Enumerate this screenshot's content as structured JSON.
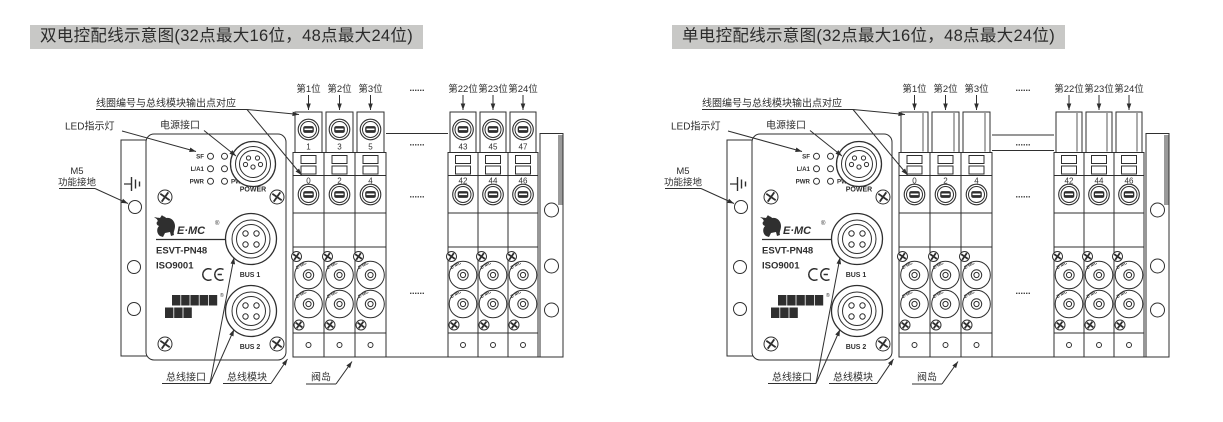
{
  "page": {
    "background": "#ffffff",
    "line_color": "#2f2f2f",
    "title_bg": "#c8c8c6",
    "title_text_color": "#2b2b2b",
    "shade_color": "#9a9a9a",
    "ellipsis": "......"
  },
  "diagrams": [
    {
      "variant": "dual",
      "title": "双电控配线示意图(32点最大16位，48点最大24位)",
      "callouts": {
        "coil_note": "线圈编号与总线模块输出点对应",
        "led": "LED指示灯",
        "power": "电源接口",
        "m5": [
          "M5",
          "功能接地"
        ],
        "bus_port": "总线接口",
        "bus_module": "总线模块",
        "valve_island": "阀岛"
      },
      "module": {
        "led_left": [
          "SF",
          "L/A1",
          "PWR"
        ],
        "led_right": [
          "BF",
          "L/A2",
          "PWM"
        ],
        "power_label": "POWER",
        "brand": "E·MC",
        "brand_reg": "®",
        "model": "ESVT-PN48",
        "cert": "ISO9001",
        "ce_mark": "CE",
        "fieldbus_logo": [
          "PROFI",
          "NET"
        ],
        "fieldbus_reg": "®",
        "bus1_label": "BUS 1",
        "bus2_label": "BUS 2",
        "coil_brand": "E·MC"
      },
      "valve_positions": {
        "left": [
          "第1位",
          "第2位",
          "第3位"
        ],
        "right": [
          "第22位",
          "第23位",
          "第24位"
        ]
      },
      "coil_numbers": {
        "top_left": [
          "1",
          "3",
          "5"
        ],
        "top_right": [
          "43",
          "45",
          "47"
        ],
        "bottom_left": [
          "0",
          "2",
          "4"
        ],
        "bottom_right": [
          "42",
          "44",
          "46"
        ]
      }
    },
    {
      "variant": "single",
      "title": "单电控配线示意图(32点最大16位，48点最大24位)",
      "callouts": {
        "coil_note": "线圈编号与总线模块输出点对应",
        "led": "LED指示灯",
        "power": "电源接口",
        "m5": [
          "M5",
          "功能接地"
        ],
        "bus_port": "总线接口",
        "bus_module": "总线模块",
        "valve_island": "阀岛"
      },
      "module": {
        "led_left": [
          "SF",
          "L/A1",
          "PWR"
        ],
        "led_right": [
          "BF",
          "L/A2",
          "PWM"
        ],
        "power_label": "POWER",
        "brand": "E·MC",
        "brand_reg": "®",
        "model": "ESVT-PN48",
        "cert": "ISO9001",
        "ce_mark": "CE",
        "fieldbus_logo": [
          "PROFI",
          "NET"
        ],
        "fieldbus_reg": "®",
        "bus1_label": "BUS 1",
        "bus2_label": "BUS 2",
        "coil_brand": "E·MC"
      },
      "valve_positions": {
        "left": [
          "第1位",
          "第2位",
          "第3位"
        ],
        "right": [
          "第22位",
          "第23位",
          "第24位"
        ]
      },
      "coil_numbers": {
        "top_left": [],
        "top_right": [],
        "bottom_left": [
          "0",
          "2",
          "4"
        ],
        "bottom_right": [
          "42",
          "44",
          "46"
        ]
      }
    }
  ]
}
